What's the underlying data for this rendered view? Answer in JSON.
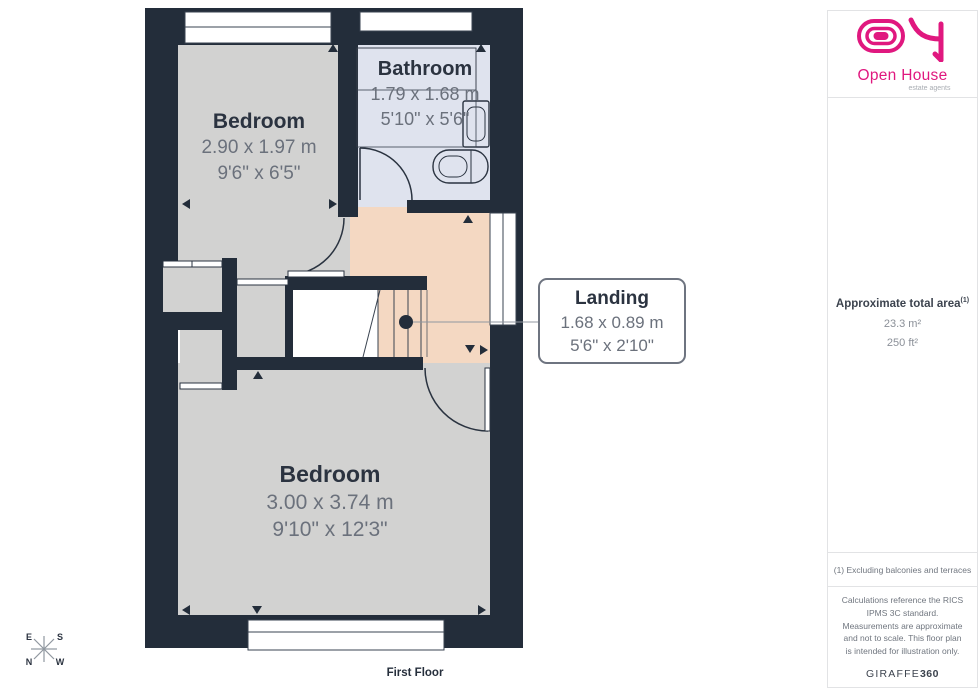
{
  "plan": {
    "floor_label": "First Floor",
    "rooms": [
      {
        "name": "Bedroom",
        "metric": "2.90 x 1.97 m",
        "imperial": "9'6\" x 6'5\""
      },
      {
        "name": "Bathroom",
        "metric": "1.79 x 1.68 m",
        "imperial": "5'10\" x 5'6\""
      },
      {
        "name": "Bedroom",
        "metric": "3.00 x 3.74 m",
        "imperial": "9'10\" x 12'3\""
      }
    ],
    "landing_callout": {
      "name": "Landing",
      "metric": "1.68 x 0.89 m",
      "imperial": "5'6\" x 2'10\""
    },
    "compass": {
      "e": "E",
      "s": "S",
      "n": "N",
      "w": "W"
    }
  },
  "sidebar": {
    "logo": {
      "brand": "Open House",
      "tagline": "estate agents"
    },
    "area": {
      "label": "Approximate total area",
      "superscript": "(1)",
      "metric": "23.3 m²",
      "imperial": "250 ft²"
    },
    "footnote": "(1) Excluding balconies and terraces",
    "disclaimer": "Calculations reference the RICS IPMS 3C standard. Measurements are approximate and not to scale. This floor plan is intended for illustration only.",
    "watermark": {
      "name": "GIRAFFE",
      "suffix": "360"
    }
  },
  "colors": {
    "wall": "#232d3a",
    "bedroom_floor": "#d2d2d1",
    "bathroom_floor": "#dfe3ee",
    "bathroom_recess": "#d5dbe8",
    "landing_floor": "#f4d8c2",
    "brand_magenta": "#e0187f",
    "room_name_text": "#2b3340",
    "dimension_text": "#6b717c"
  }
}
